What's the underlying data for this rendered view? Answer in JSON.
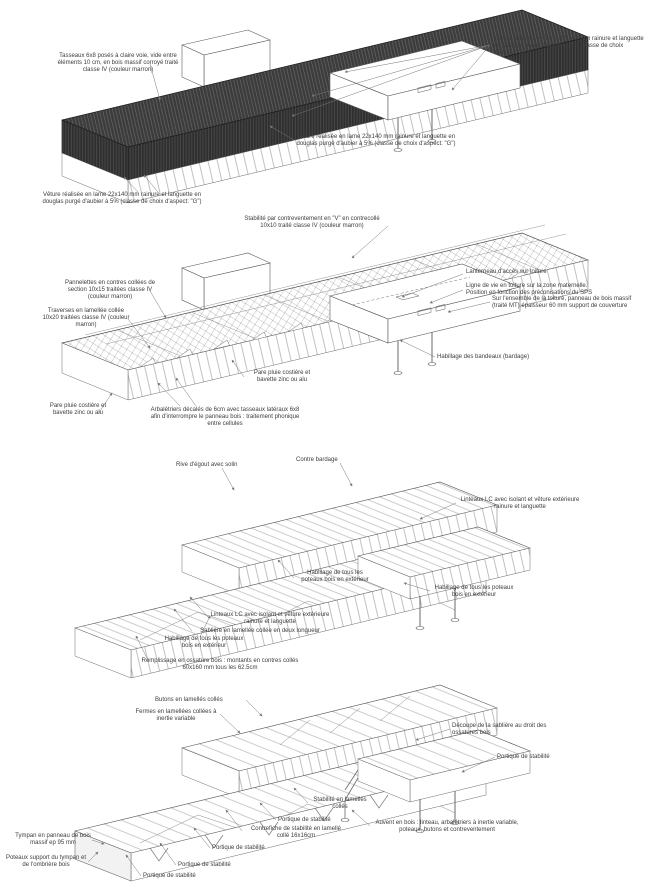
{
  "document": {
    "kind": "axonometric timber construction details, 4 stacked views",
    "language": "fr"
  },
  "colors": {
    "background": "#ffffff",
    "dark_cladding": "#3c3c3c",
    "line_ink": "#5a5a5a",
    "annotation_text": "#3d3d3d"
  },
  "annotations": {
    "v1a1": "Tasseaux 6x8 posés à claire voie, vide entre éléments 10 cm, en bois massif corroyé traité classe IV (couleur marron)",
    "v1a2": "Vêture réalisée en lame 22x140 mm rainure et languette en douglas purgé d'aubier à 5% (classe de choix d'aspect \"G\")",
    "v1a3": "Vêture réalisée en lame 22x140 mm rainure et languette en douglas purgé d'aubier à 5% (classe de choix d'aspect: \"G\")",
    "v1a4": "Vêture réalisée en lame 22x140 mm rainure et languette en douglas purgé d'aubier à 5% (classe de choix d'aspect: \"G\")",
    "v2a1": "Stabilité par contreventement en \"V\" en contrecollé 10x10 traité classe IV (couleur marron)",
    "v2a2": "Pannelettes en contres collées de section 10x15 traitées classe IV (couleur marron)",
    "v2a3": "Traverses en lamellée collée 10x20 traitées classe IV (couleur marron)",
    "v2a4": "Lanterneau d'accès sur toiture",
    "v2a5": "Ligne de vie en toiture sur la zone maternelle. Position en fonction des préconisations du SPS",
    "v2a6": "Sur l'ensemble de la toiture, panneau de bois massif (traité MT) épaisseur 60 mm support de couverture",
    "v2a7": "Habillage des bandeaux (bardage)",
    "v2a8": "Pare pluie costière et bavette zinc ou alu",
    "v2a9": "Pare pluie costière et bavette zinc ou alu",
    "v2a10": "Arbalétriers décalés de 6cm avec tasseaux latéraux 6x8 afin d'interrompre le panneau bois : traitement phonique entre cellules",
    "v3a1": "Rive d'égout avec solin",
    "v3a2": "Contre bardage",
    "v3a3": "Linteaux LC avec isolant et vêture extérieure rainure et languette",
    "v3a4": "Habillage de tous les poteaux bois en extérieur",
    "v3a5": "Linteaux LC avec isolant et vêture extérieure rainure et languette",
    "v3a6": "Sablière en lamellée collée en deux longueur",
    "v3a7": "Habillage de tous les poteaux bois en extérieur",
    "v3a8": "Habillage de tous les poteaux bois en extérieur",
    "v3a9": "Remplissage en ossature bois : montants en contres collés 60x160 mm tous les 62.5cm",
    "v4a1": "Butons en lamellés collés",
    "v4a2": "Fermes en lamellées collées à inertie variable",
    "v4a3": "Découpe de la sablière au droit des ossatures bois",
    "v4a4": "Portique de stabilité",
    "v4a5": "Stabilité en lamellés collés",
    "v4a6": "Portique de stabilité",
    "v4a7": "Contrefiche de stabilité en lamellé collé 16x16cm",
    "v4a8": "Auvent en bois : linteau, arbalétriers à inertie variable, poteaux, butons et contreventement",
    "v4a9": "Portique de stabilité",
    "v4a10": "Portique de stabilité",
    "v4a11": "Portique de stabilité",
    "v4a12": "Tympan en panneau de bois massif ep 95 mm",
    "v4a13": "Poteaux support du tympan et de l'ombrière bois"
  }
}
